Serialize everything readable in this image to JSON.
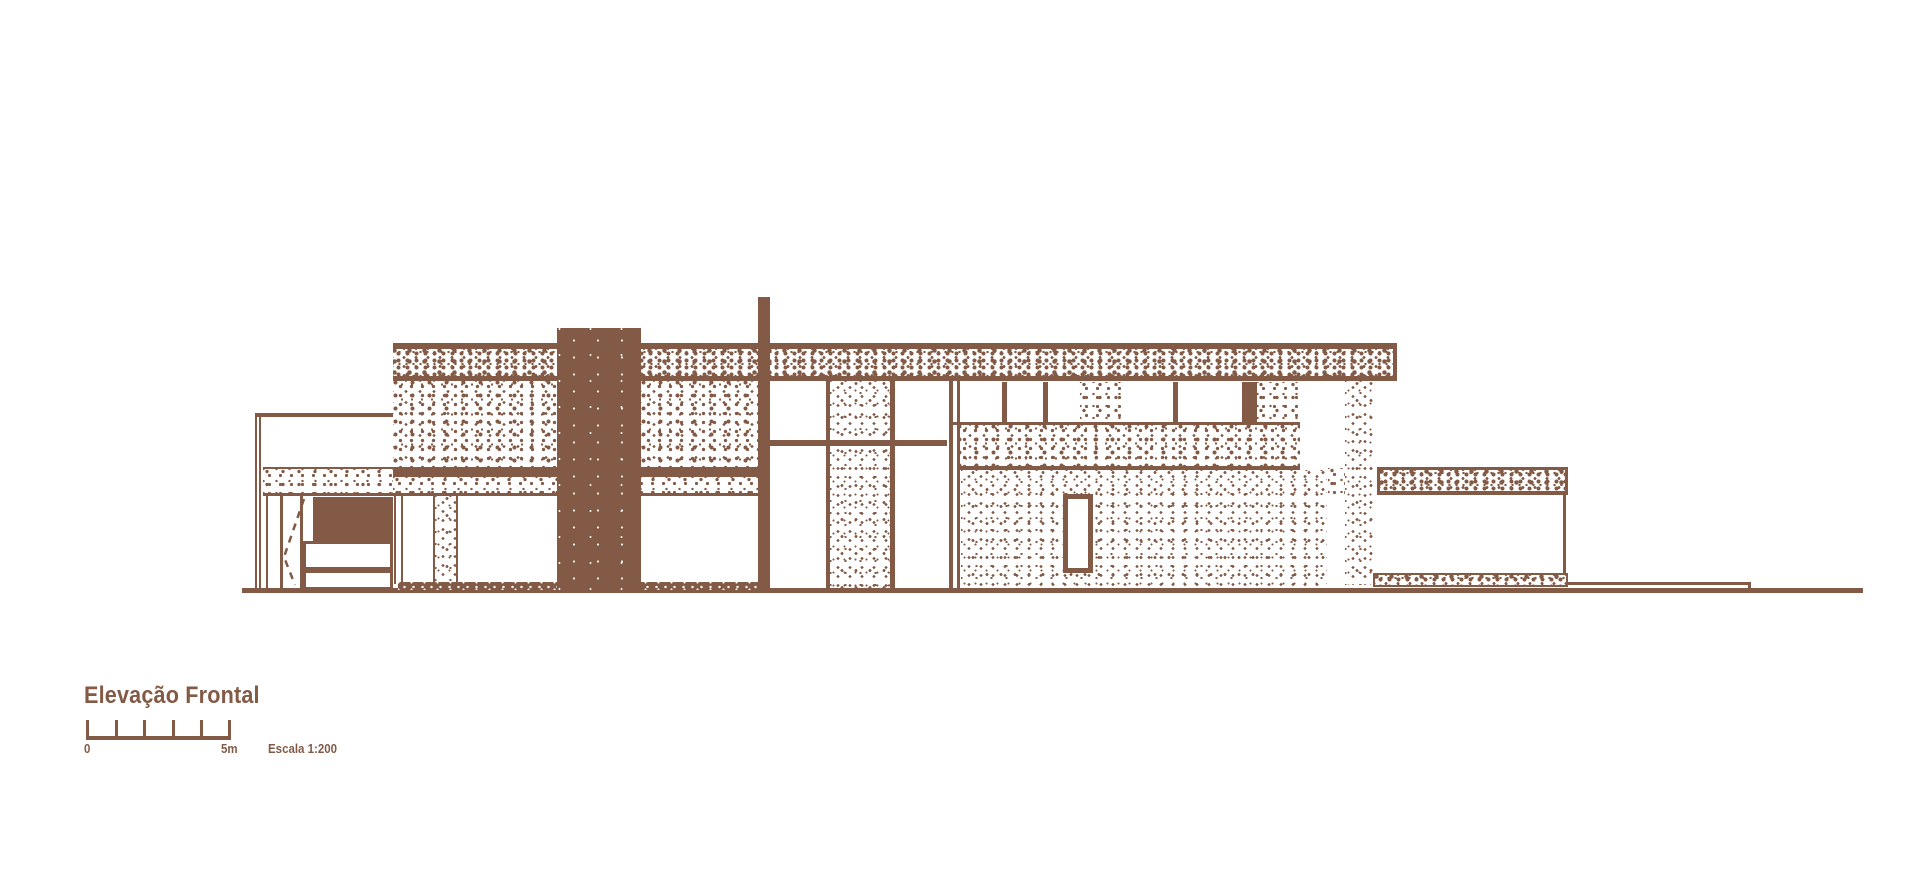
{
  "colors": {
    "ink": "#835a46",
    "paper": "#ffffff"
  },
  "title_block": {
    "title": "Elevação Frontal",
    "scale_bar": {
      "start_label": "0",
      "end_label": "5m",
      "scale_note": "Escala 1:200",
      "tick_count": 6
    }
  },
  "drawing": {
    "view": "front elevation"
  }
}
